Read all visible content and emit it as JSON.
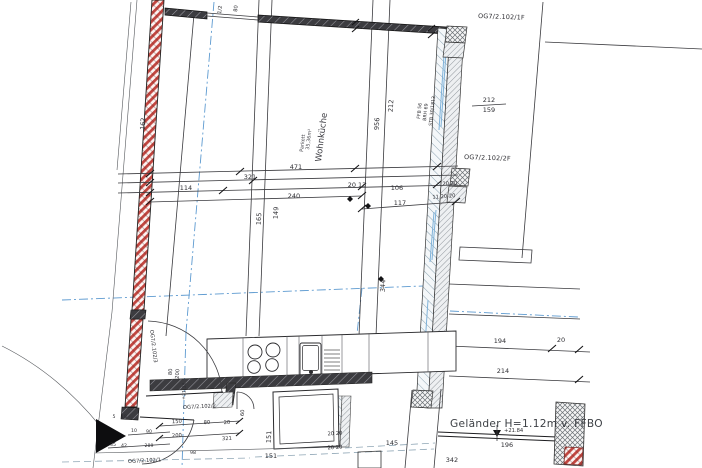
{
  "room": {
    "name": "Wohnküche",
    "area": "35,36m²",
    "floor": "Parkett"
  },
  "refs": {
    "top_right_1f": "OG7/2.102/1F",
    "mid_right_2f": "OG7/2.102/2F",
    "left_wall_3": "OG7/2.102/3",
    "kitchen_2": "OG7/2.102/2",
    "bottom_1": "OG7/2.102/1"
  },
  "notes": {
    "railing": "Geländer H=1.12m v. FFBO",
    "level_upper": "+21.84",
    "level_floor": "+21,38",
    "window_ffb": "FFB 56",
    "window_brh": "BRH 69",
    "window_stb": "STB 30/1813",
    "wall_top_a": "1/2",
    "wall_top_b": "80"
  },
  "dims": {
    "w471": "471",
    "w321": "321",
    "w114": "114",
    "w240": "240",
    "w20_13": "20 13",
    "w106": "106",
    "w117": "117",
    "h165": "165",
    "h149": "149",
    "h956": "956",
    "h212": "212",
    "h344": "344",
    "h162": "162",
    "r212": "212",
    "r159": "159",
    "j20_20": "20 20",
    "j11_20_20": "11 20 20",
    "b194": "194",
    "b20": "20",
    "b214": "214",
    "b196": "196",
    "b342": "342",
    "b145": "145",
    "s151v": "151",
    "s151h": "151",
    "s20_20a": "20 20",
    "s20_20b": "20 20",
    "door1_w": "80",
    "door1_h": "200",
    "door3_w": "60",
    "k150": "150",
    "k80": "80",
    "k200": "200",
    "k321": "321",
    "k20": "20",
    "e90": "90",
    "e10": "10",
    "e98": "98",
    "e5": "5",
    "e18": "18",
    "e35": "35",
    "e42": "42",
    "e289": "289"
  },
  "colors": {
    "brick_red": "#c2453f",
    "axis_blue": "#5d9ad0",
    "wall_dark": "#3c3c40",
    "hatch_grey": "#7f98a8"
  }
}
